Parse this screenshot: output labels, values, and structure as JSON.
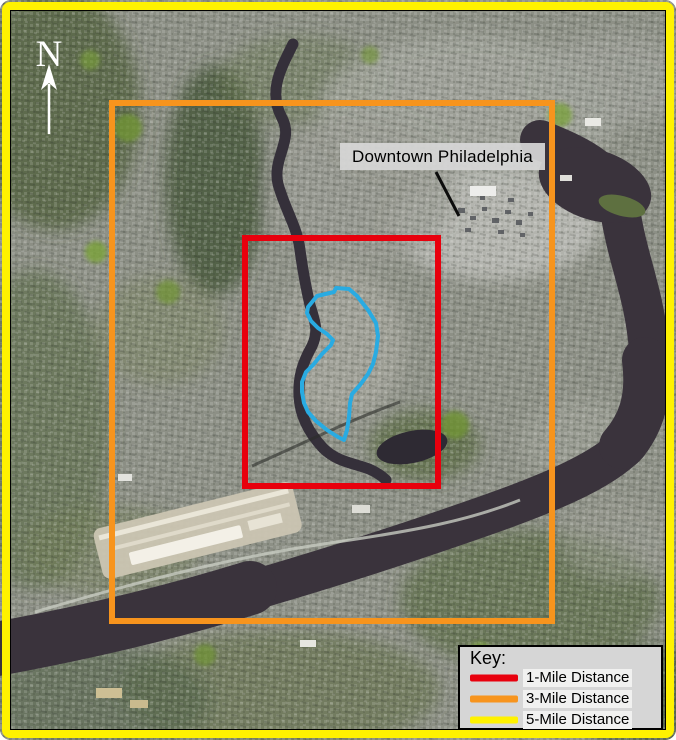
{
  "figure": {
    "north_label": "N",
    "annotation": {
      "downtown_label": "Downtown Philadelphia"
    },
    "legend": {
      "title": "Key:",
      "items": [
        {
          "label": "1-Mile Distance",
          "color": "#E8000D"
        },
        {
          "label": "3-Mile Distance",
          "color": "#F7941D"
        },
        {
          "label": "5-Mile Distance",
          "color": "#FFF200"
        }
      ]
    },
    "overlays": {
      "one_mile_color": "#E8000D",
      "three_mile_color": "#F7941D",
      "five_mile_color": "#FFF200",
      "site_outline_color": "#29ABE2"
    }
  }
}
